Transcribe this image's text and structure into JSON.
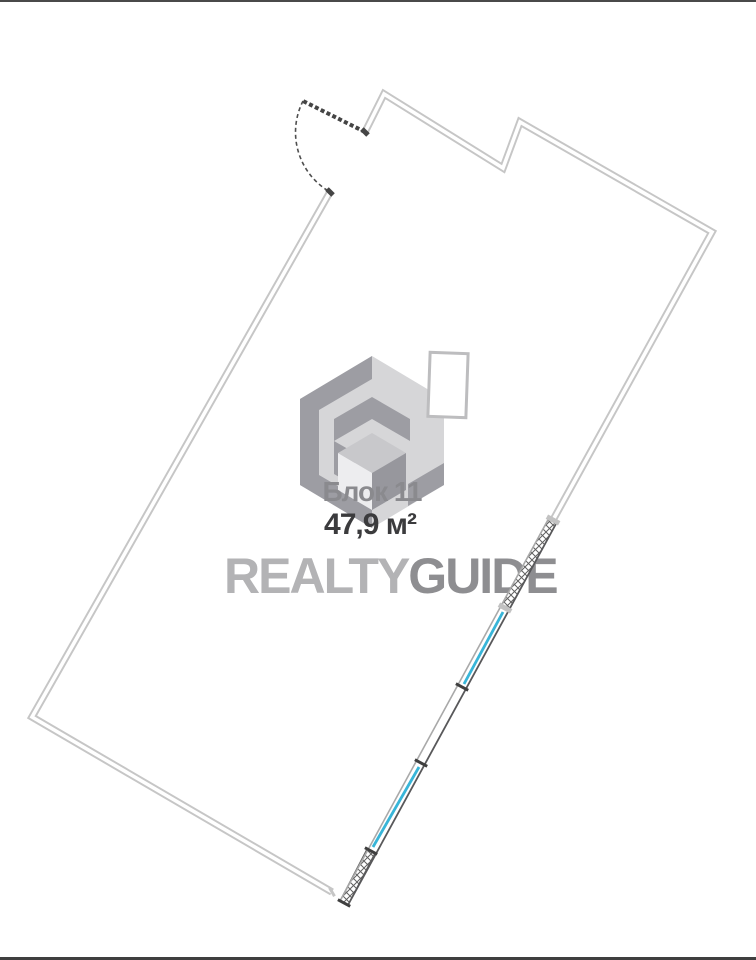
{
  "page": {
    "width": 756,
    "height": 960,
    "background": "#ffffff",
    "top_rule_color": "#4a4a4a",
    "bottom_rule_color": "#3f3f3f"
  },
  "watermark": {
    "block_label": "Блок 11",
    "area_label": "47,9 м²",
    "brand_left": "REALTY",
    "brand_right": "GUIDE",
    "colors": {
      "block_label": "#8a8a8e",
      "area_label": "#3b3b3d",
      "brand_left": "#b3b3b5",
      "brand_right": "#8e8e91",
      "logo_medium": "#9d9da3",
      "logo_light": "#d6d6d8",
      "cube_top": "#c8c8cb",
      "cube_left": "#ededef",
      "cube_right": "#97979d",
      "frame_fill": "#ffffff",
      "frame_stroke": "#bdbdbf"
    },
    "logo": {
      "hexagon_points": "372,356 444,399 444,485 372,528 300,485 300,399",
      "outer_band_points": "372,356 300,399 300,485 372,528 372,506 319,475 319,410 372,379",
      "tail_points": "444,463 444,485 408,506 408,484",
      "chevron_points": "372,397 410,419 410,441 372,419 334,441 334,419",
      "connector_points": "334,441 334,474 355,486 355,453",
      "cube_top_points": "372,433 406,453 372,473 338,453",
      "cube_left_points": "338,453 372,473 372,510 338,490",
      "cube_right_points": "406,453 406,490 372,510 372,473",
      "frame_rect": {
        "x": 429,
        "y": 353,
        "width": 38,
        "height": 64,
        "rotate_deg": 2
      }
    }
  },
  "plan": {
    "colors": {
      "wall": "#c6c6c6",
      "wall_core": "#ffffff",
      "band_inner_edge": "#a9a9a9",
      "band_outer_edge": "#58585a",
      "window": "#38b5d8",
      "door": "#454545",
      "door_arc": "#4f4f4f",
      "tick_dark": "#3f3f3f",
      "tick_light": "#c2c2c2",
      "hatch_line": "#606060",
      "hatch_fill": "#ffffff"
    },
    "paths": {
      "walls": "M 365,132 L 384,94 L 503,168 L 520,122 L 712,232 L 553,520 M 330,192 L 32,717 L 332,892",
      "band_inner_edge": "M 549,518 L 340,901",
      "band_outer_edge": "M 557,522 L 348,905",
      "window1": "M 503,612 L 464,684",
      "window2": "M 419,767 L 373,847",
      "hatch1_points": "549,518 557,522 509,610 501,606",
      "hatch2_points": "367,849 375,853 348,905 340,901",
      "door_leaf": "M 365,132 L 303,101",
      "door_arc": "M 303,101 A 69 69 0 0 0 330,192",
      "jamb_top": "M 362,129 l 6,6",
      "jamb_bottom": "M 327,189 l 6,6",
      "tick_light1": "M 546.9,516.7 L 559.2,523.3",
      "tick_light2": "M 498.9,604.7 L 511.2,611.3",
      "tick_dark1": "M 455.9,683.7 L 468.2,690.3",
      "tick_dark2": "M 414.9,759.7 L 427.2,766.3",
      "tick_dark3": "M 364.9,847.7 L 377.2,854.3",
      "tick_dark4": "M 337.9,899.7 L 350.2,906.3",
      "cap_left_wall_end": "M 326.2,189.8 L 333.8,194.2",
      "cap_bottom_wall_end": "M 329.5,887.7 L 334.5,896.3"
    }
  }
}
